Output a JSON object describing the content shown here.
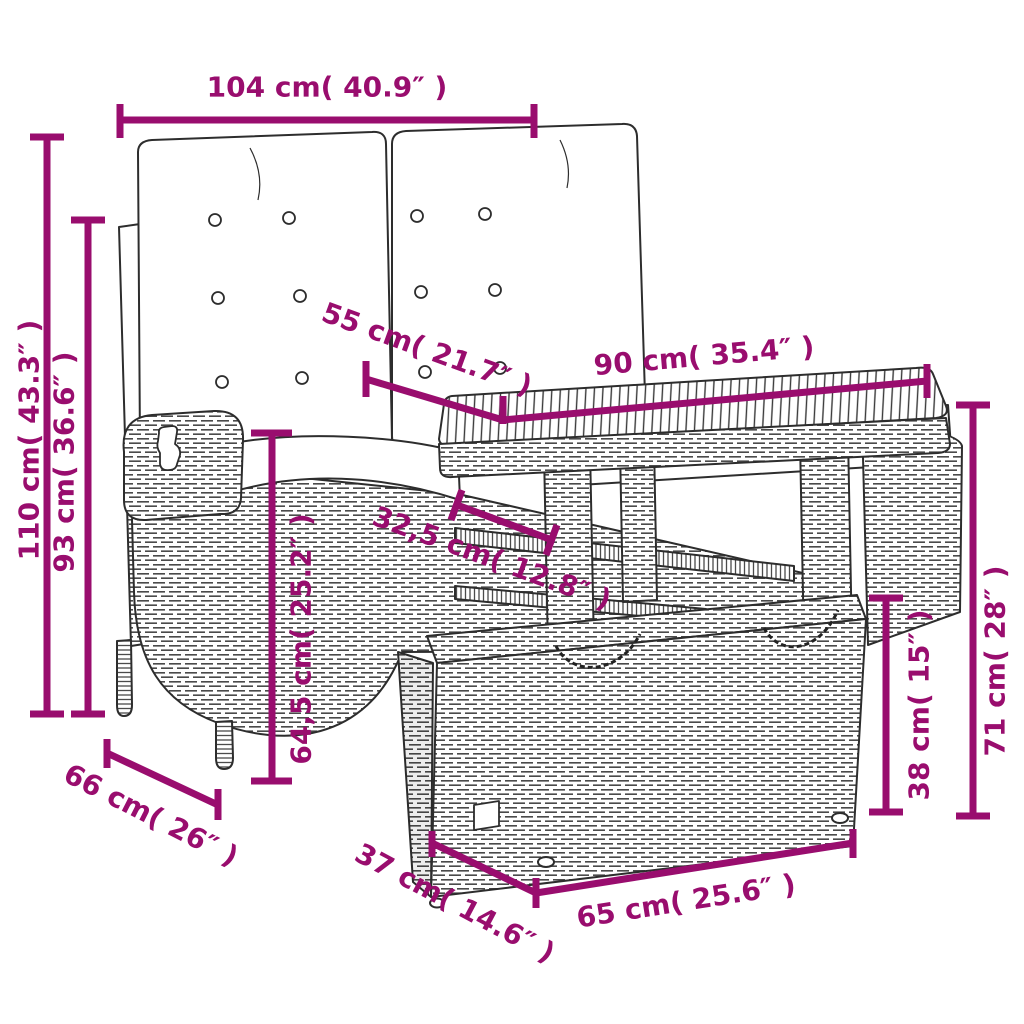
{
  "page": {
    "background": "#ffffff"
  },
  "diagram": {
    "title": "garden furniture set dimension diagram",
    "product": "2-seater reclining rattan garden bench with cushions, slatted-top rattan table and rattan storage ottoman",
    "style": "black line-art drawing with magenta dimension lines",
    "accent_color": "#990d6e",
    "line_color": "#2d2d2d",
    "dims": {
      "bench_width": "104 cm( 40.9″ )",
      "bench_height": "110 cm( 43.3″ )",
      "backrest_height": "93 cm( 36.6″ )",
      "table_depth": "55 cm( 21.7″ )",
      "table_width": "90 cm( 35.4″ )",
      "table_overhang": "32,5 cm( 12.8″ )",
      "seat_side_height": "64,5 cm( 25.2″ )",
      "table_height": "71 cm( 28″ )",
      "ottoman_height": "38 cm( 15″ )",
      "bench_depth": "66 cm( 26″ )",
      "ottoman_depth": "37 cm( 14.6″ )",
      "ottoman_width": "65 cm( 25.6″ )"
    }
  }
}
